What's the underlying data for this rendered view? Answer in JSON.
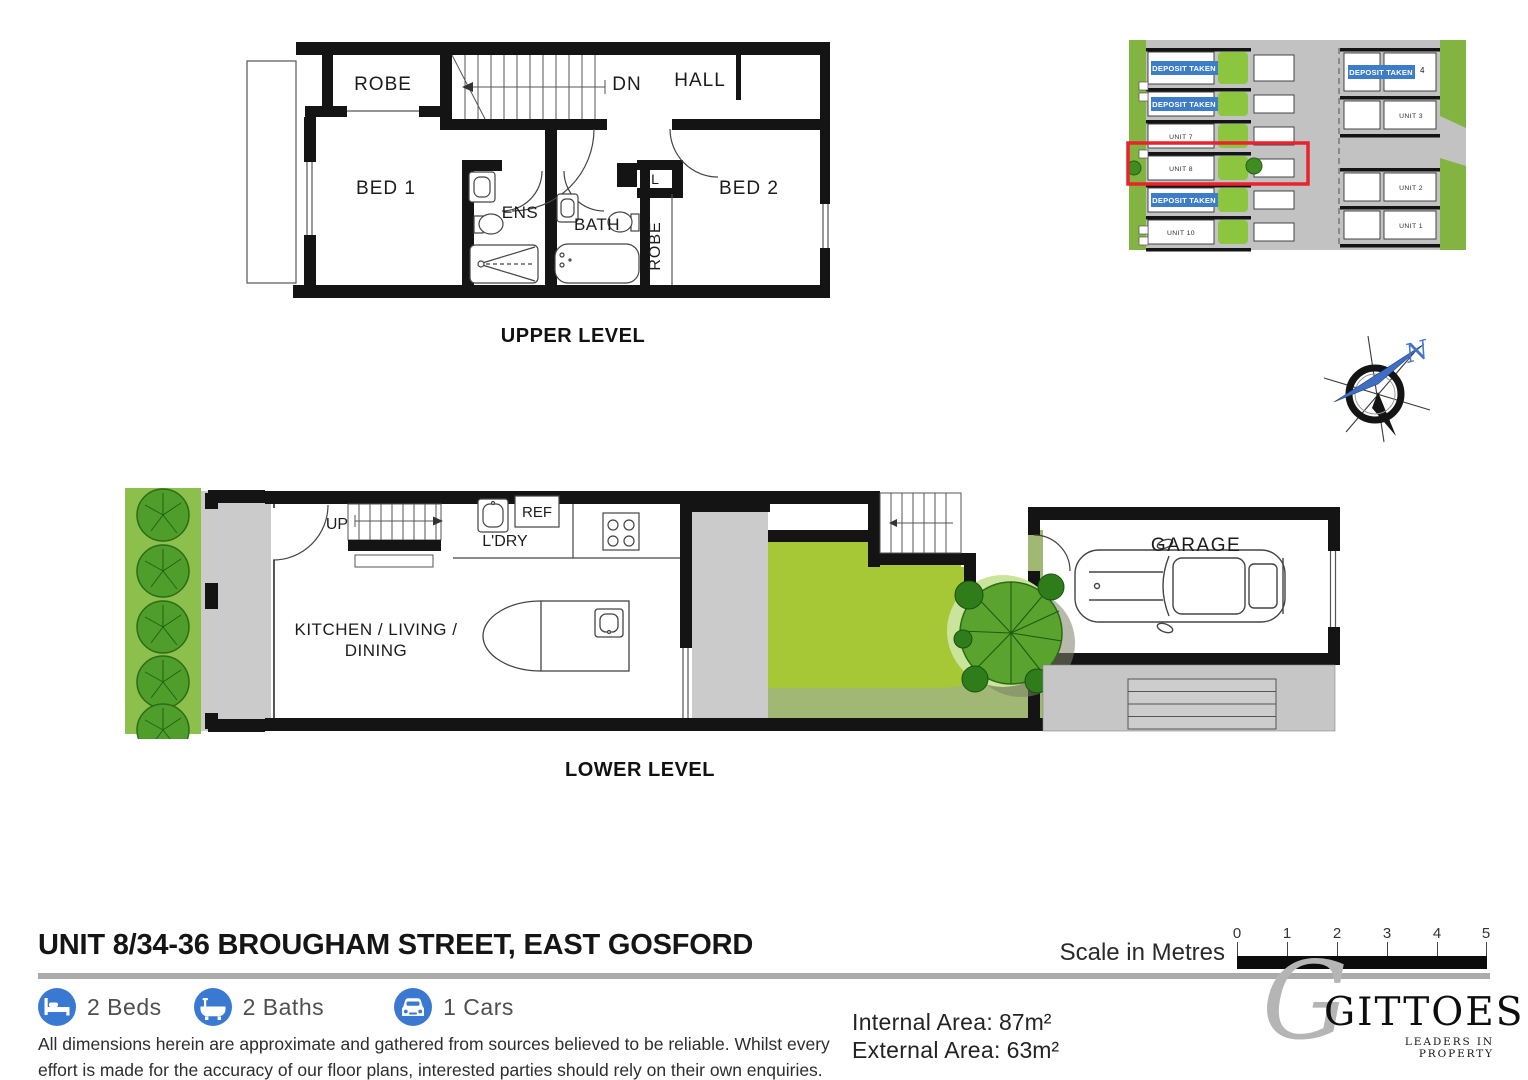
{
  "upper_plan": {
    "caption": "UPPER LEVEL",
    "labels": {
      "robe_top": "ROBE",
      "dn": "DN",
      "hall": "HALL",
      "bed1": "BED 1",
      "ens": "ENS",
      "bath": "BATH",
      "linen": "L",
      "robe_side": "ROBE",
      "bed2": "BED 2"
    }
  },
  "lower_plan": {
    "caption": "LOWER LEVEL",
    "labels": {
      "up": "UP",
      "ref": "REF",
      "ldry": "L'DRY",
      "kitchen_line1": "KITCHEN / LIVING /",
      "kitchen_line2": "DINING",
      "garage": "GARAGE"
    }
  },
  "site_plan": {
    "highlight_color": "#e8232b",
    "badge_color": "#3d7cc9",
    "lawn_color": "#8cc63f",
    "left_units": [
      "DEPOSIT TAKEN",
      "DEPOSIT TAKEN",
      "UNIT 7",
      "UNIT 8",
      "DEPOSIT TAKEN",
      "UNIT 10"
    ],
    "right_units": [
      "DEPOSIT TAKEN",
      "UNIT 3",
      "UNIT 2",
      "UNIT 1"
    ],
    "unit4_superscript": "4"
  },
  "compass": {
    "north_label": "N"
  },
  "footer": {
    "title": "UNIT 8/34-36 BROUGHAM STREET, EAST GOSFORD",
    "feature_icon_color": "#3a79d2",
    "features": [
      {
        "icon": "bed-icon",
        "label": "2 Beds"
      },
      {
        "icon": "bath-icon",
        "label": "2 Baths"
      },
      {
        "icon": "car-icon",
        "label": "1 Cars"
      }
    ],
    "disclaimer_line1": "All dimensions herein are approximate and gathered from sources believed to be reliable. Whilst every",
    "disclaimer_line2": "effort is made for the accuracy of our floor plans, interested parties should rely on their own enquiries.",
    "scale": {
      "label": "Scale in Metres",
      "ticks": [
        "0",
        "1",
        "2",
        "3",
        "4",
        "5"
      ]
    },
    "areas": {
      "internal_label": "Internal Area:",
      "internal_value": "87m²",
      "external_label": "External Area:",
      "external_value": "63m²"
    },
    "logo": {
      "monogram": "G",
      "name": "GITTOES",
      "tagline": "LEADERS IN PROPERTY"
    }
  }
}
